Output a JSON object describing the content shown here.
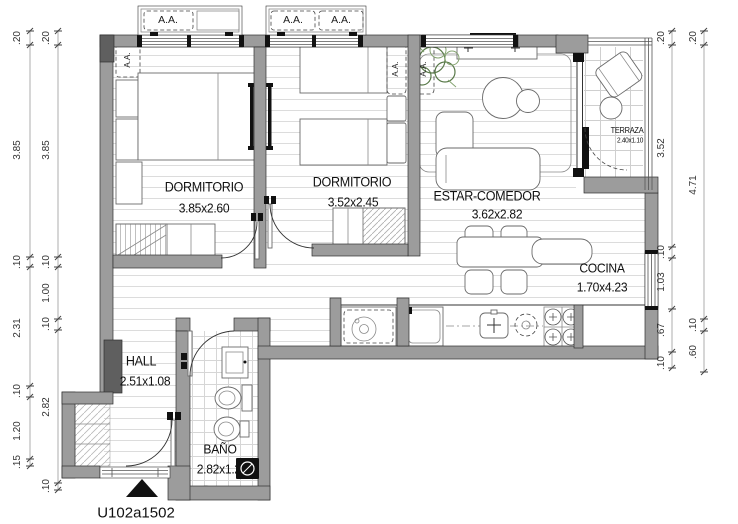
{
  "unit_label": "U102a1502",
  "ac_unit_label": "A.A.",
  "rooms": {
    "dormitorio1": {
      "name": "DORMITORIO",
      "dims": "3.85x2.60"
    },
    "dormitorio2": {
      "name": "DORMITORIO",
      "dims": "3.52x2.45"
    },
    "estar": {
      "name": "ESTAR-COMEDOR",
      "dims": "3.62x2.82"
    },
    "cocina": {
      "name": "COCINA",
      "dims": "1.70x4.23"
    },
    "terraza": {
      "name": "TERRAZA",
      "dims": "2.40x1.10"
    },
    "hall": {
      "name": "HALL",
      "dims": "2.51x1.08"
    },
    "bano": {
      "name": "BAÑO",
      "dims": "2.82x1.28"
    }
  },
  "dimensions": {
    "left_outer": [
      ".20",
      "3.85",
      ".10",
      "2.31",
      ".10",
      "1.20",
      ".15"
    ],
    "left_inner": [
      ".20",
      "3.85",
      ".10",
      "1.00",
      ".10",
      "2.82",
      ".10"
    ],
    "right_inner": [
      ".20",
      "3.52",
      ".10",
      "1.03",
      ".67",
      ".10"
    ],
    "right_outer": [
      ".20",
      "4.71",
      ".10",
      ".60"
    ]
  },
  "colors": {
    "wall": "#9c9c9c",
    "wall_dark": "#5f5f5f",
    "floor_line": "#dcdcdc",
    "plant": "#5a7a4a"
  }
}
